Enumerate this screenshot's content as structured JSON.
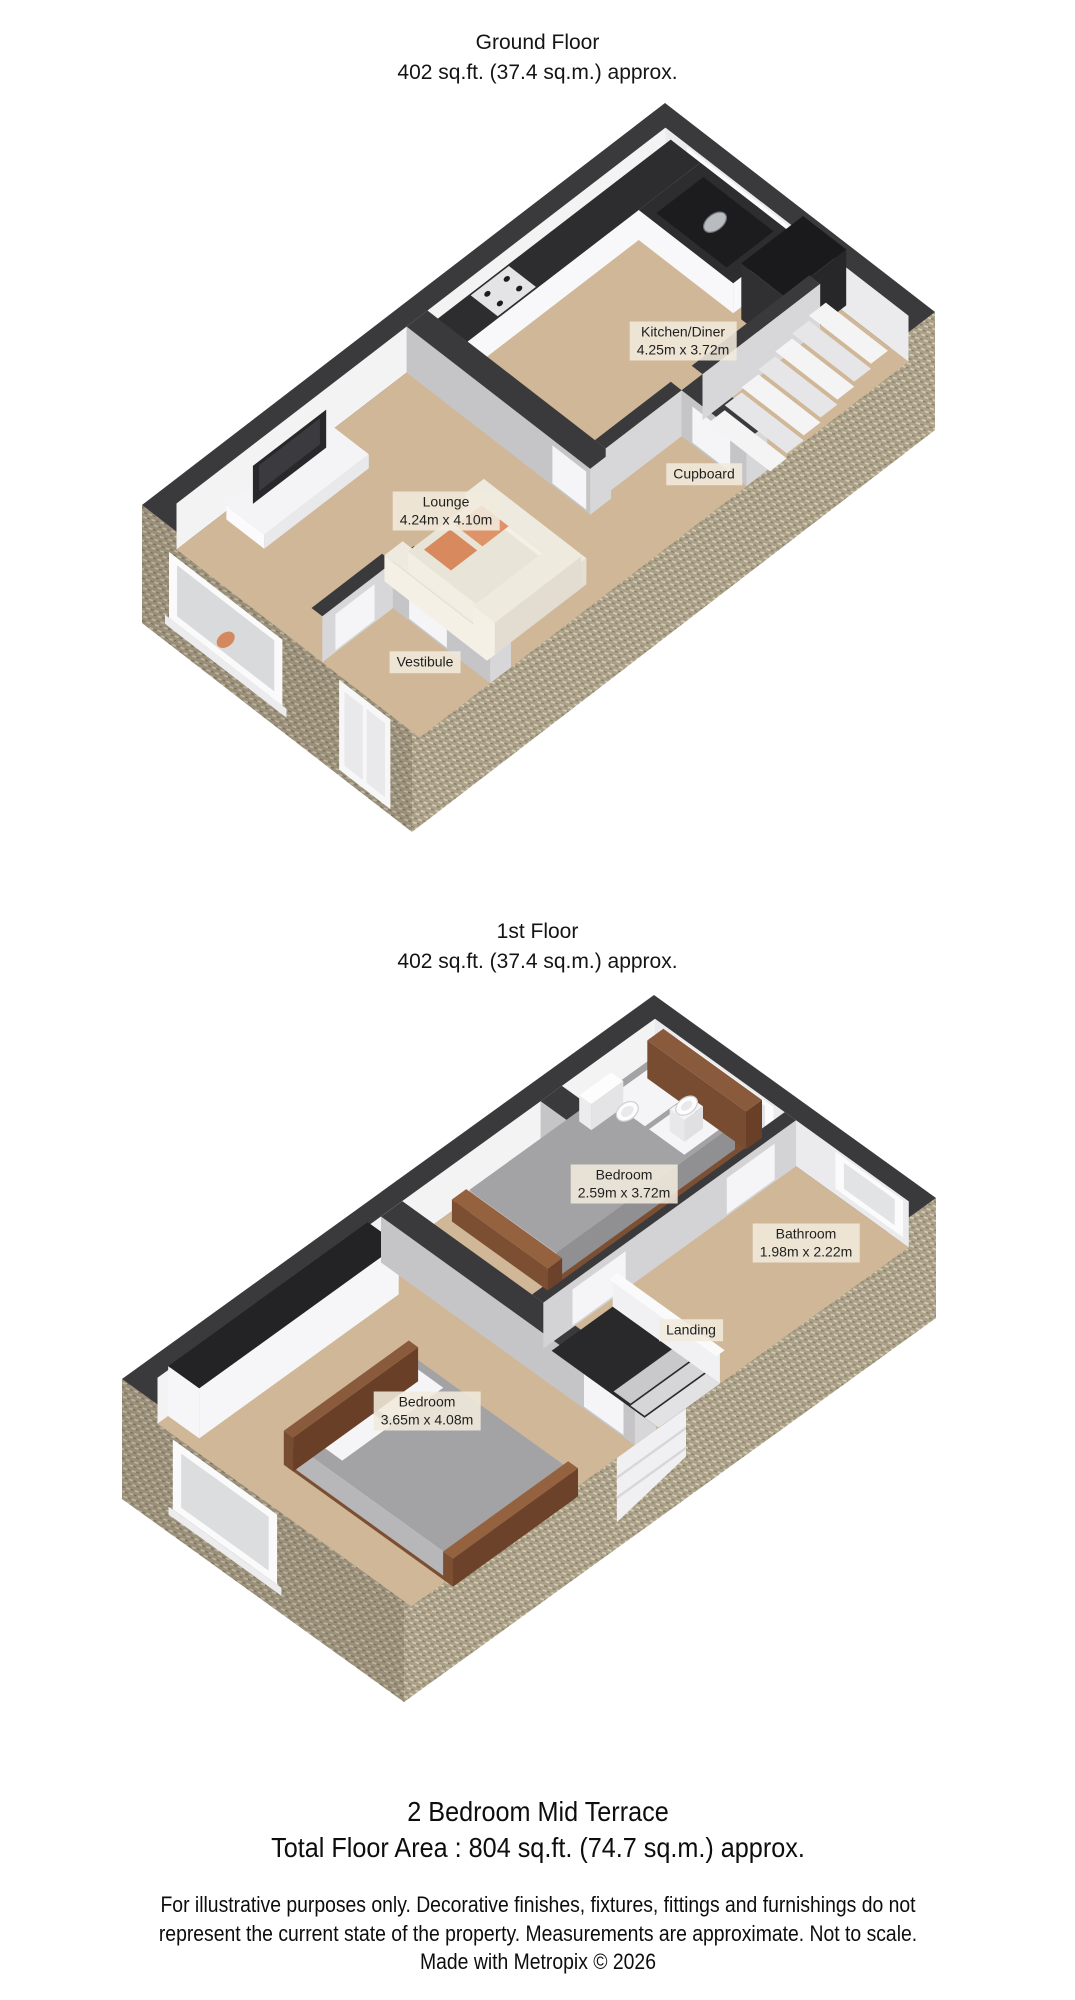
{
  "ground": {
    "title": "Ground Floor",
    "area": "402 sq.ft. (37.4 sq.m.) approx.",
    "rooms": [
      {
        "name": "Kitchen/Diner",
        "dims": "4.25m x 3.72m"
      },
      {
        "name": "Lounge",
        "dims": "4.24m x 4.10m"
      },
      {
        "name": "Cupboard",
        "dims": ""
      },
      {
        "name": "Vestibule",
        "dims": ""
      }
    ]
  },
  "first": {
    "title": "1st Floor",
    "area": "402 sq.ft. (37.4 sq.m.) approx.",
    "rooms": [
      {
        "name": "Bedroom",
        "dims": "2.59m x 3.72m"
      },
      {
        "name": "Bathroom",
        "dims": "1.98m x 2.22m"
      },
      {
        "name": "Landing",
        "dims": ""
      },
      {
        "name": "Bedroom",
        "dims": "3.65m x 4.08m"
      }
    ]
  },
  "footer": {
    "property_type": "2 Bedroom Mid Terrace",
    "total_area": "Total Floor Area : 804 sq.ft. (74.7 sq.m.) approx.",
    "disclaimer_line1": "For illustrative purposes only. Decorative finishes, fixtures, fittings and furnishings do not",
    "disclaimer_line2": "represent the current state of the property. Measurements are approximate. Not to scale.",
    "credit": "Made with Metropix © 2026"
  },
  "colors": {
    "wall_dark": "#3a3a3c",
    "floor": "#cfb797",
    "interior_wall_white": "#f3f3f4",
    "interior_wall_shaded": "#c5c5c8",
    "ext_base": "#aba089",
    "ext_light": "#d6cdb3",
    "ext_dark": "#877c64",
    "sofa_accent": "#d8895e",
    "bed_frame": "#8a5a3c",
    "duvet": "#a3a3a6"
  }
}
